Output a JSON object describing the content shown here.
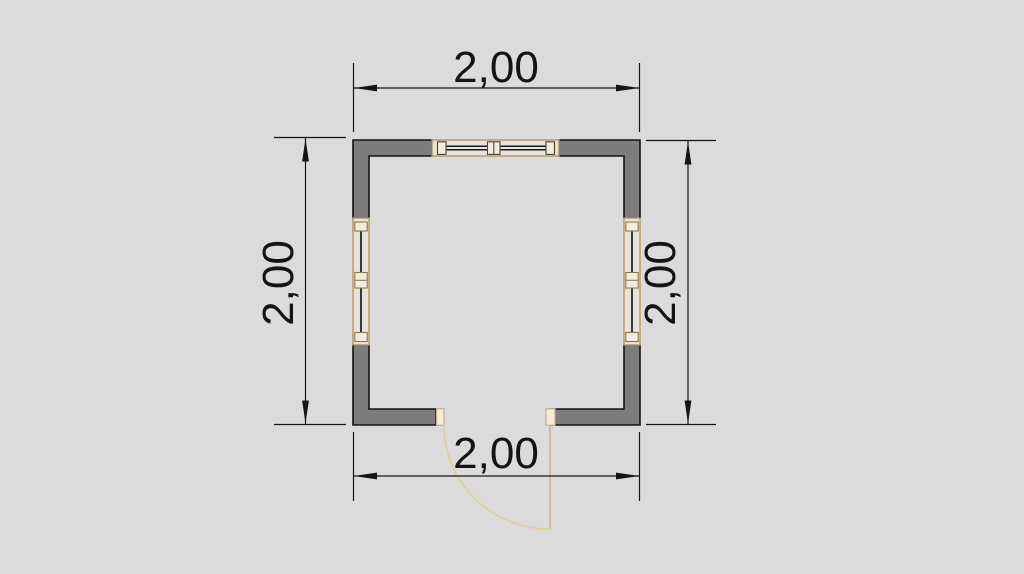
{
  "drawing": {
    "type": "architectural-floor-plan",
    "room_size_label": "2,00 x 2,00",
    "elements": [
      "top-window",
      "left-window",
      "right-window",
      "bottom-door-with-swing"
    ]
  },
  "dimensions": {
    "top": "2,00",
    "bottom": "2,00",
    "left": "2,00",
    "right": "2,00"
  },
  "colors": {
    "background": "#DBDBDB",
    "wall_fill": "#7D7D7D",
    "wall_outline": "#141414",
    "dimension_line": "#141414",
    "dimension_text": "#141414",
    "window_frame": "#B1996B",
    "window_block_fill": "#F2ECDC",
    "window_glass_line": "#161A26",
    "door_frame": "#C9B183",
    "door_swing_arc": "#E2CD9C"
  }
}
